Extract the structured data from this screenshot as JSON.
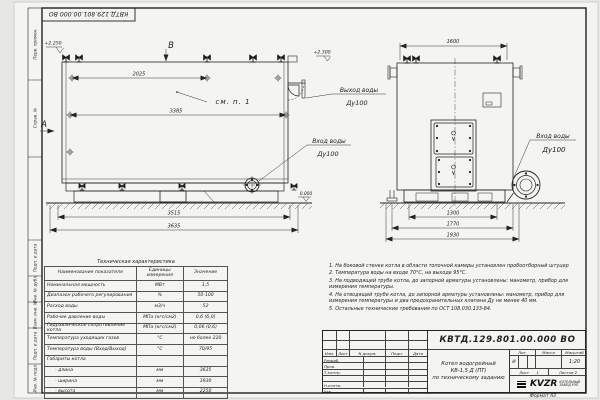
{
  "stamp_top": {
    "doc_number": "КВТД.129.801.00.000 ВО"
  },
  "margin": {
    "top": [
      "Перв. примен.",
      "Справ. №"
    ],
    "bottom": [
      "Подп. и дата",
      "Инв. № дубл.",
      "Взам. инв. №",
      "Подп. и дата",
      "Инв. № подл."
    ]
  },
  "side_view": {
    "view_label": "В",
    "section_label": "А",
    "level_top": "+2.250",
    "level_zero": "0.000",
    "see_note": "см. п. 1",
    "dim_lugs": "2025",
    "dim_shell": "3385",
    "dim_base": "3515",
    "dim_overall": "3635",
    "inlet_label": "Вход воды",
    "inlet_size": "Ду100"
  },
  "front_view": {
    "level_top": "+2.300",
    "dim_width": "1600",
    "dim_base": "1300",
    "dim_frame": "1770",
    "dim_overall": "1930",
    "outlet_label": "Выход воды",
    "outlet_size": "Ду100",
    "inlet_label": "Вход воды",
    "inlet_size": "Ду100"
  },
  "spec_table": {
    "title": "Техническая характеристика",
    "headers": [
      "Наименование показателя",
      "Единицы измерения",
      "Значение"
    ],
    "rows": [
      [
        "Номинальная мощность",
        "МВт",
        "1,5"
      ],
      [
        "Диапазон рабочего регулирования",
        "%",
        "50-100"
      ],
      [
        "Расход воды",
        "м3/ч",
        "52"
      ],
      [
        "Рабочее давление воды",
        "МПа (кгс/см2)",
        "0,6 (6,0)"
      ],
      [
        "Гидравлическое сопротивление котла",
        "МПа (кгс/см2)",
        "0,06 (0,6)"
      ],
      [
        "Температура уходящих газов",
        "°С",
        "не более 220"
      ],
      [
        "Температура воды (Вход/Выход)",
        "°С",
        "70/95"
      ],
      [
        "Габариты котла",
        "",
        ""
      ],
      [
        "- длина",
        "мм",
        "3635"
      ],
      [
        "- ширина",
        "мм",
        "1930"
      ],
      [
        "- высота",
        "мм",
        "2250"
      ]
    ]
  },
  "notes": {
    "items": [
      "1.  На боковой стенке котла в области топочной камеры установлен пробоотборный штуцер",
      "2.  Температура воды на входе 70°С, на выходе 95°С.",
      "3.  На подводящей трубе котла, до запорной арматуры установлены: манометр, прибор для измерения температуры.",
      "4.  На отводящей трубе котла, до запорной арматуры установлены: манометр, прибор для измерения температуры и два предохранительных клапана Ду не менее 40 мм.",
      "5.  Остальные технические требования по ОСТ 108.030.133-84."
    ]
  },
  "title_block": {
    "doc_number": "КВТД.129.801.00.000  ВО",
    "product": [
      "Котел водогрейный",
      "КВ-1,5 Д (ПТ)",
      "по техническому заданию"
    ],
    "cols": [
      "Изм.",
      "Лист",
      "N докум.",
      "Подп.",
      "Дата"
    ],
    "roles": [
      "Разраб.",
      "Пров.",
      "Т.контр.",
      "Н.контр.",
      "Утв."
    ],
    "lit_label": "Лит.",
    "lit_value": "И",
    "mass_label": "Масса",
    "scale_label": "Масштаб",
    "scale_value": "1:20",
    "sheet_label": "Лист",
    "sheet_value": "1",
    "sheets_label": "Листов",
    "sheets_value": "2",
    "logo": "KVZR",
    "company": [
      "КОТЕЛЬНЫЙ",
      "ЗАВОД РЭП"
    ]
  },
  "footer": {
    "format": "Формат  А3"
  }
}
